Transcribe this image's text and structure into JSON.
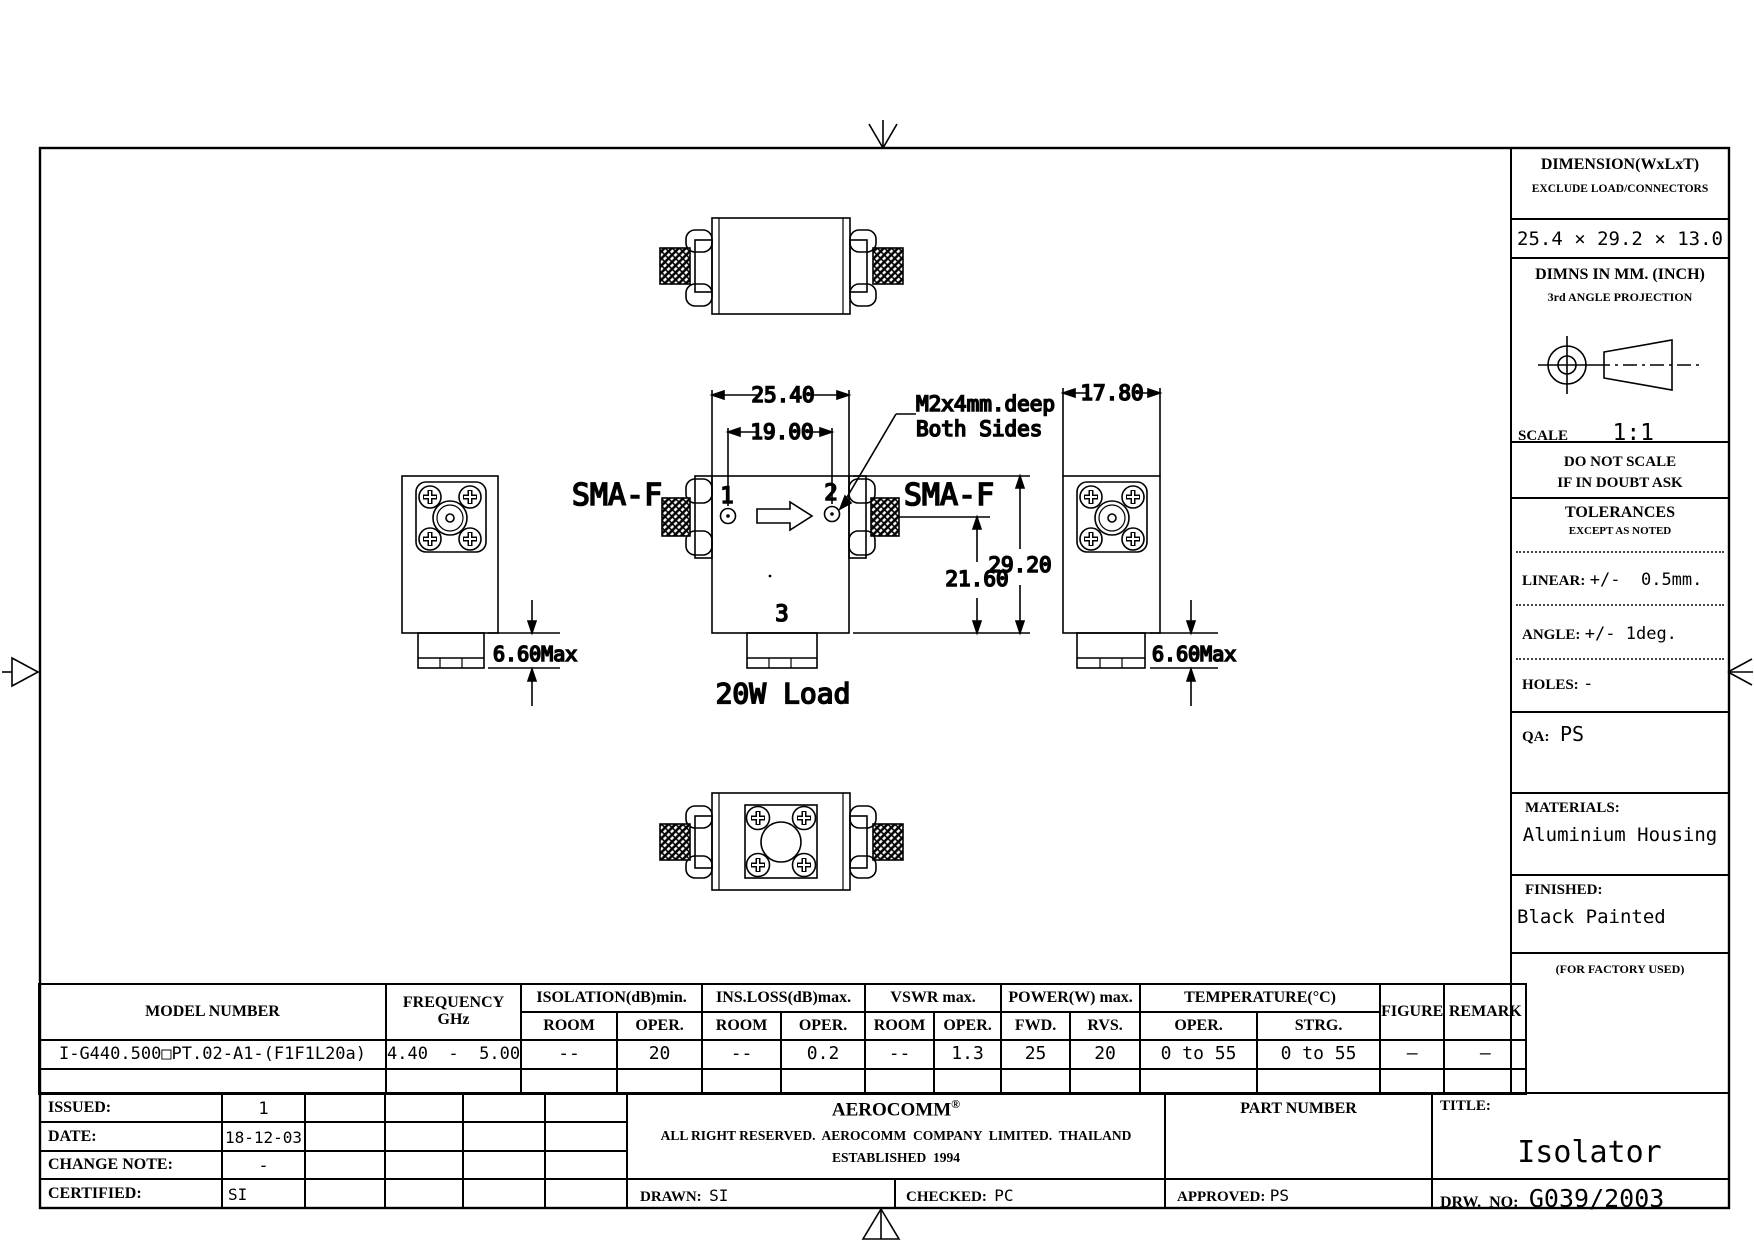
{
  "right_panel": {
    "dimension_title": "DIMENSION(WxLxT)",
    "dimension_sub": "EXCLUDE LOAD/CONNECTORS",
    "dimension_value": "25.4 × 29.2 × 13.0",
    "dimns_title": "DIMNS IN MM. (INCH)",
    "dimns_sub": "3rd ANGLE PROJECTION",
    "scale_label": "SCALE",
    "scale_value": "1:1",
    "do_not_scale_line1": "DO NOT SCALE",
    "do_not_scale_line2": "IF IN DOUBT ASK",
    "tolerances_title": "TOLERANCES",
    "tolerances_sub": "EXCEPT AS NOTED",
    "linear_label": "LINEAR:",
    "linear_value": "+/-  0.5mm.",
    "angle_label": "ANGLE:",
    "angle_value": "+/- 1deg.",
    "holes_label": "HOLES:",
    "holes_value": "-",
    "qa_label": "QA:",
    "qa_value": "PS",
    "materials_label": "MATERIALS:",
    "materials_value": "Aluminium Housing",
    "finished_label": "FINISHED:",
    "finished_value": "Black Painted",
    "factory_note": "(FOR FACTORY USED)"
  },
  "drawing": {
    "labels": {
      "sma_left": "SMA-F",
      "sma_right": "SMA-F",
      "port1": "1",
      "port2": "2",
      "port3": "3",
      "load": "20W Load",
      "hole_note_line1": "M2x4mm.deep",
      "hole_note_line2": "Both Sides"
    },
    "dims": {
      "width_outer": "25.40",
      "hole_spacing": "19.00",
      "height": "29.20",
      "center_to_bottom": "21.60",
      "side_width": "17.80",
      "stub_left": "6.60Max",
      "stub_right": "6.60Max"
    }
  },
  "spec_table": {
    "col_model": "MODEL NUMBER",
    "col_frequency_line1": "FREQUENCY",
    "col_frequency_line2": "GHz",
    "group_isolation": "ISOLATION(dB)min.",
    "group_insloss": "INS.LOSS(dB)max.",
    "group_vswr": "VSWR  max.",
    "group_power": "POWER(W)  max.",
    "group_temperature": "TEMPERATURE(°C)",
    "col_figure": "FIGURE",
    "col_remark": "REMARK",
    "subheads": [
      "ROOM",
      "OPER.",
      "ROOM",
      "OPER.",
      "ROOM",
      "OPER.",
      "FWD.",
      "RVS.",
      "OPER.",
      "STRG."
    ],
    "row": {
      "model": "I-G440.500□PT.02-A1-(F1F1L20a)",
      "frequency": "4.40  -  5.00",
      "values": [
        "--",
        "20",
        "--",
        "0.2",
        "--",
        "1.3",
        "25",
        "20",
        "0 to 55",
        "0 to 55"
      ],
      "figure": "—",
      "remark": "—"
    }
  },
  "title_block": {
    "issued_label": "ISSUED:",
    "issued_value": "1",
    "date_label": "DATE:",
    "date_value": "18-12-03",
    "change_label": "CHANGE NOTE:",
    "change_value": "-",
    "certified_label": "CERTIFIED:",
    "certified_value": "SI",
    "company_name": "AEROCOMM",
    "company_reg": "®",
    "company_line1": "ALL RIGHT RESERVED.  AEROCOMM  COMPANY  LIMITED.  THAILAND",
    "company_line2": "ESTABLISHED  1994",
    "drawn_label": "DRAWN:",
    "drawn_value": "SI",
    "checked_label": "CHECKED:",
    "checked_value": "PC",
    "approved_label": "APPROVED:",
    "approved_value": "PS",
    "part_number_label": "PART NUMBER",
    "title_label": "TITLE:",
    "title_value": "Isolator",
    "drw_label": "DRW.  NO:",
    "drw_value": "G039/2003"
  }
}
